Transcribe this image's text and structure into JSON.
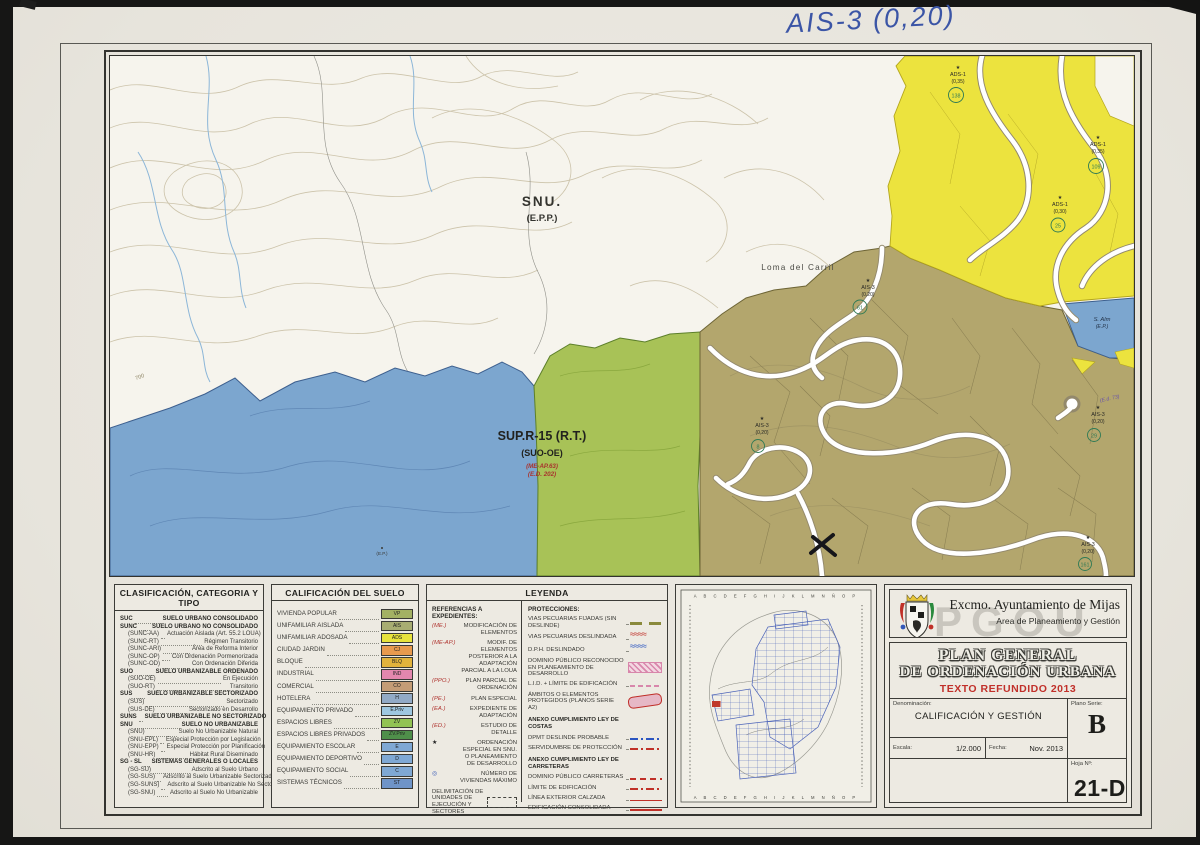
{
  "scan": {
    "handwritten_note": "AIS-3 (0,20)"
  },
  "map": {
    "colors": {
      "blue_sup": "#7ca6cf",
      "green_sup": "#a8c257",
      "olive": "#b3a66d",
      "yellow": "#ece33e"
    },
    "labels": {
      "zone_snu": "SNU.",
      "zone_snu_sub": "(E.P.P.)",
      "place_name": "Loma del Carril",
      "sup_title": "SUP.R-15 (R.T.)",
      "sup_sub": "(SUO-OE)",
      "sup_ref1": "(ME-AP.63)",
      "sup_ref2": "(E.D. 202)",
      "contour_value": "700",
      "coast_zone": "S. Alm",
      "coast_zone_sub": "(E.P.)",
      "blue_spot": "(E.P.)",
      "ref_note": "(E.d. 73)"
    },
    "markers": [
      {
        "star": "★",
        "code": "AIS-3",
        "coef": "(0,20)",
        "num": "61"
      },
      {
        "star": "★",
        "code": "AIS-3",
        "coef": "(0,20)",
        "num": "8"
      },
      {
        "star": "★",
        "code": "AIS-3",
        "coef": "(0,20)",
        "num": "29"
      },
      {
        "star": "★",
        "code": "AIS-3",
        "coef": "(0,20)",
        "num": "161"
      },
      {
        "star": "★",
        "code": "ADS-1",
        "coef": "(0,35)",
        "num": "138"
      },
      {
        "star": "★",
        "code": "ADS-1",
        "coef": "(0,35)",
        "num": "109"
      },
      {
        "star": "★",
        "code": "ADS-1",
        "coef": "(0,30)",
        "num": "25"
      }
    ]
  },
  "clasificacion": {
    "title": "CLASIFICACIÓN, CATEGORIA Y TIPO",
    "rows": [
      {
        "c": "SUC",
        "t": "SUELO URBANO CONSOLIDADO",
        "cls": "hd"
      },
      {
        "c": "SUNC",
        "t": "SUELO URBANO NO CONSOLIDADO",
        "cls": "hd"
      },
      {
        "c": "(SUNC-AA)",
        "t": "Actuación Aislada (Art. 55.2 LOUA)",
        "cls": "sub"
      },
      {
        "c": "(SUNC-RT)",
        "t": "Régimen Transitorio",
        "cls": "sub"
      },
      {
        "c": "(SUNC-ARI)",
        "t": "Área de Reforma Interior",
        "cls": "sub"
      },
      {
        "c": "(SUNC-OP)",
        "t": "Con Ordenación Pormenorizada",
        "cls": "sub"
      },
      {
        "c": "(SUNC-OD)",
        "t": "Con Ordenación Diferida",
        "cls": "sub"
      },
      {
        "c": "SUO",
        "t": "SUELO URBANIZABLE ORDENADO",
        "cls": "hd"
      },
      {
        "c": "(SUO-OE)",
        "t": "En Ejecución",
        "cls": "sub"
      },
      {
        "c": "(SUO-RT)",
        "t": "Transitorio",
        "cls": "sub"
      },
      {
        "c": "SUS",
        "t": "SUELO URBANIZABLE SECTORIZADO",
        "cls": "hd"
      },
      {
        "c": "(SUS)",
        "t": "Sectorizado",
        "cls": "sub"
      },
      {
        "c": "(SUS-DE)",
        "t": "Sectorizado en Desarrollo",
        "cls": "sub"
      },
      {
        "c": "SUNS",
        "t": "SUELO URBANIZABLE NO SECTORIZADO",
        "cls": "hd"
      },
      {
        "c": "SNU",
        "t": "SUELO NO URBANIZABLE",
        "cls": "hd"
      },
      {
        "c": "(SNU)",
        "t": "Suelo No Urbanizable Natural",
        "cls": "sub"
      },
      {
        "c": "(SNU-EPL)",
        "t": "Especial Protección por Legislación",
        "cls": "sub"
      },
      {
        "c": "(SNU-EPP)",
        "t": "Especial Protección por Planificación",
        "cls": "sub"
      },
      {
        "c": "(SNU-HR)",
        "t": "Hábitat Rural Diseminado",
        "cls": "sub"
      },
      {
        "c": "SG - SL",
        "t": "SISTEMAS GENERALES O LOCALES",
        "cls": "hd"
      },
      {
        "c": "(SG-SU)",
        "t": "Adscrito al Suelo Urbano",
        "cls": "sub"
      },
      {
        "c": "(SG-SUS)",
        "t": "Adscrito al Suelo Urbanizable Sectorizado",
        "cls": "sub"
      },
      {
        "c": "(SG-SUNS)",
        "t": "Adscrito al Suelo Urbanizable No Sectorizado",
        "cls": "sub"
      },
      {
        "c": "(SG-SNU)",
        "t": "Adscrito al Suelo No Urbanizable",
        "cls": "sub"
      }
    ]
  },
  "calificacion": {
    "title": "CALIFICACIÓN DEL SUELO",
    "rows": [
      {
        "t": "VIVIENDA POPULAR",
        "code": "VP",
        "color": "#a3b163"
      },
      {
        "t": "UNIFAMILIAR AISLADA",
        "code": "AIS",
        "color": "#a8ad72"
      },
      {
        "t": "UNIFAMILIAR ADOSADA",
        "code": "ADS",
        "color": "#e8e33c"
      },
      {
        "t": "CIUDAD JARDIN",
        "code": "CJ",
        "color": "#e89a4e"
      },
      {
        "t": "BLOQUE",
        "code": "BLQ",
        "color": "#e2b33c"
      },
      {
        "t": "INDUSTRIAL",
        "code": "IND",
        "color": "#e387ae"
      },
      {
        "t": "COMERCIAL",
        "code": "CO",
        "color": "#c49c76"
      },
      {
        "t": "HOTELERA",
        "code": "H",
        "color": "#92aac6"
      },
      {
        "t": "EQUIPAMIENTO PRIVADO",
        "code": "E.Priv",
        "color": "#9ec7e0"
      },
      {
        "t": "ESPACIOS LIBRES",
        "code": "ZV",
        "color": "#92c353"
      },
      {
        "t": "ESPACIOS LIBRES PRIVADOS",
        "code": "ZV.Priv",
        "color": "#4f8f4a"
      },
      {
        "t": "EQUIPAMIENTO ESCOLAR",
        "code": "E",
        "color": "#7fa8d4"
      },
      {
        "t": "EQUIPAMIENTO DEPORTIVO",
        "code": "D",
        "color": "#7fa8d4"
      },
      {
        "t": "EQUIPAMIENTO SOCIAL",
        "code": "C",
        "color": "#7fa8d4"
      },
      {
        "t": "SISTEMAS TÉCNICOS",
        "code": "ST",
        "color": "#6f94c8"
      }
    ]
  },
  "leyenda": {
    "title": "LEYENDA",
    "ref_title": "REFERENCIAS A EXPEDIENTES:",
    "referencias": [
      {
        "c": "(ME.)",
        "t": "MODIFICACIÓN DE ELEMENTOS",
        "ccls": "red"
      },
      {
        "c": "(ME-AP.)",
        "t": "MODIF. DE ELEMENTOS POSTERIOR A LA ADAPTACIÓN PARCIAL A LA LOUA",
        "ccls": "red"
      },
      {
        "c": "(PPO.)",
        "t": "PLAN PARCIAL DE ORDENACIÓN",
        "ccls": "red"
      },
      {
        "c": "(PE.)",
        "t": "PLAN ESPECIAL",
        "ccls": "red"
      },
      {
        "c": "(EA.)",
        "t": "EXPEDIENTE DE ADAPTACIÓN",
        "ccls": "red"
      },
      {
        "c": "(ED.)",
        "t": "ESTUDIO DE DETALLE",
        "ccls": "red"
      },
      {
        "c": "★",
        "t": "ORDENACIÓN ESPECIAL EN SNU. O PLANEAMIENTO DE DESARROLLO",
        "ccls": "blk"
      },
      {
        "c": "◎",
        "t": "NÚMERO DE VIVIENDAS MÁXIMO",
        "ccls": "blu"
      }
    ],
    "delim": "DELIMITACIÓN DE UNIDADES DE EJECUCIÓN Y SECTORES",
    "prot_title": "PROTECCIONES:",
    "protecciones": [
      {
        "t": "VIAS PECUARIAS FIJADAS (SIN DESLINDE)",
        "sym": "s-dash-olive",
        "cls": ""
      },
      {
        "t": "VIAS PECUARIAS DESLINDADA",
        "sym": "s-wave-red",
        "cls": ""
      },
      {
        "t": "D.P.H. DESLINDADO",
        "sym": "s-wave-blue",
        "cls": ""
      },
      {
        "t": "DOMINIO PÚBLICO RECONOCIDO EN PLANEAMIENTO DE DESARROLLO",
        "sym": "s-hatch-pink",
        "cls": ""
      },
      {
        "t": "L.I.D. + LÍMITE DE EDIFICACIÓN",
        "sym": "s-dash-pink",
        "cls": ""
      },
      {
        "t": "ÁMBITOS O ELEMENTOS PROTEGIDOS (PLANOS SERIE A2)",
        "sym": "s-blob-red",
        "cls": ""
      },
      {
        "t": "ANEXO CUMPLIMIENTO LEY DE COSTAS",
        "sym": "s-none",
        "cls": "phd"
      },
      {
        "t": "DPMT DESLINDE PROBABLE",
        "sym": "s-dashdot-blue",
        "cls": ""
      },
      {
        "t": "SERVIDUMBRE DE PROTECCIÓN",
        "sym": "s-dashdot-red",
        "cls": ""
      },
      {
        "t": "ANEXO CUMPLIMIENTO LEY DE CARRETERAS",
        "sym": "s-none",
        "cls": "phd"
      },
      {
        "t": "DOMINIO PÚBLICO CARRETERAS",
        "sym": "s-dash-red",
        "cls": ""
      },
      {
        "t": "LÍMITE DE EDIFICACIÓN",
        "sym": "s-dashdot-red2",
        "cls": ""
      },
      {
        "t": "LÍNEA EXTERIOR CALZADA",
        "sym": "s-line-red-thin",
        "cls": ""
      },
      {
        "t": "EDIFICACIÓN CONSOLIDADA",
        "sym": "s-line-red",
        "cls": ""
      }
    ]
  },
  "index_map": {
    "col_letters": "A B C D E F G H I J K L M N Ñ O P"
  },
  "title_block": {
    "org": "Excmo. Ayuntamiento de Mijas",
    "dept": "Area de Planeamiento y Gestión",
    "watermark": "PGOU",
    "title1": "PLAN GENERAL",
    "title2": "DE ORDENACIÓN URBANA",
    "title3": "TEXTO REFUNDIDO 2013",
    "denominacion_label": "Denominación:",
    "denominacion": "CALIFICACIÓN Y GESTIÓN",
    "serie_label": "Plano Serie:",
    "serie": "B",
    "escala_label": "Escala:",
    "escala": "1/2.000",
    "fecha_label": "Fecha:",
    "fecha": "Nov. 2013",
    "hoja_label": "Hoja Nº:",
    "hoja": "21-D"
  }
}
